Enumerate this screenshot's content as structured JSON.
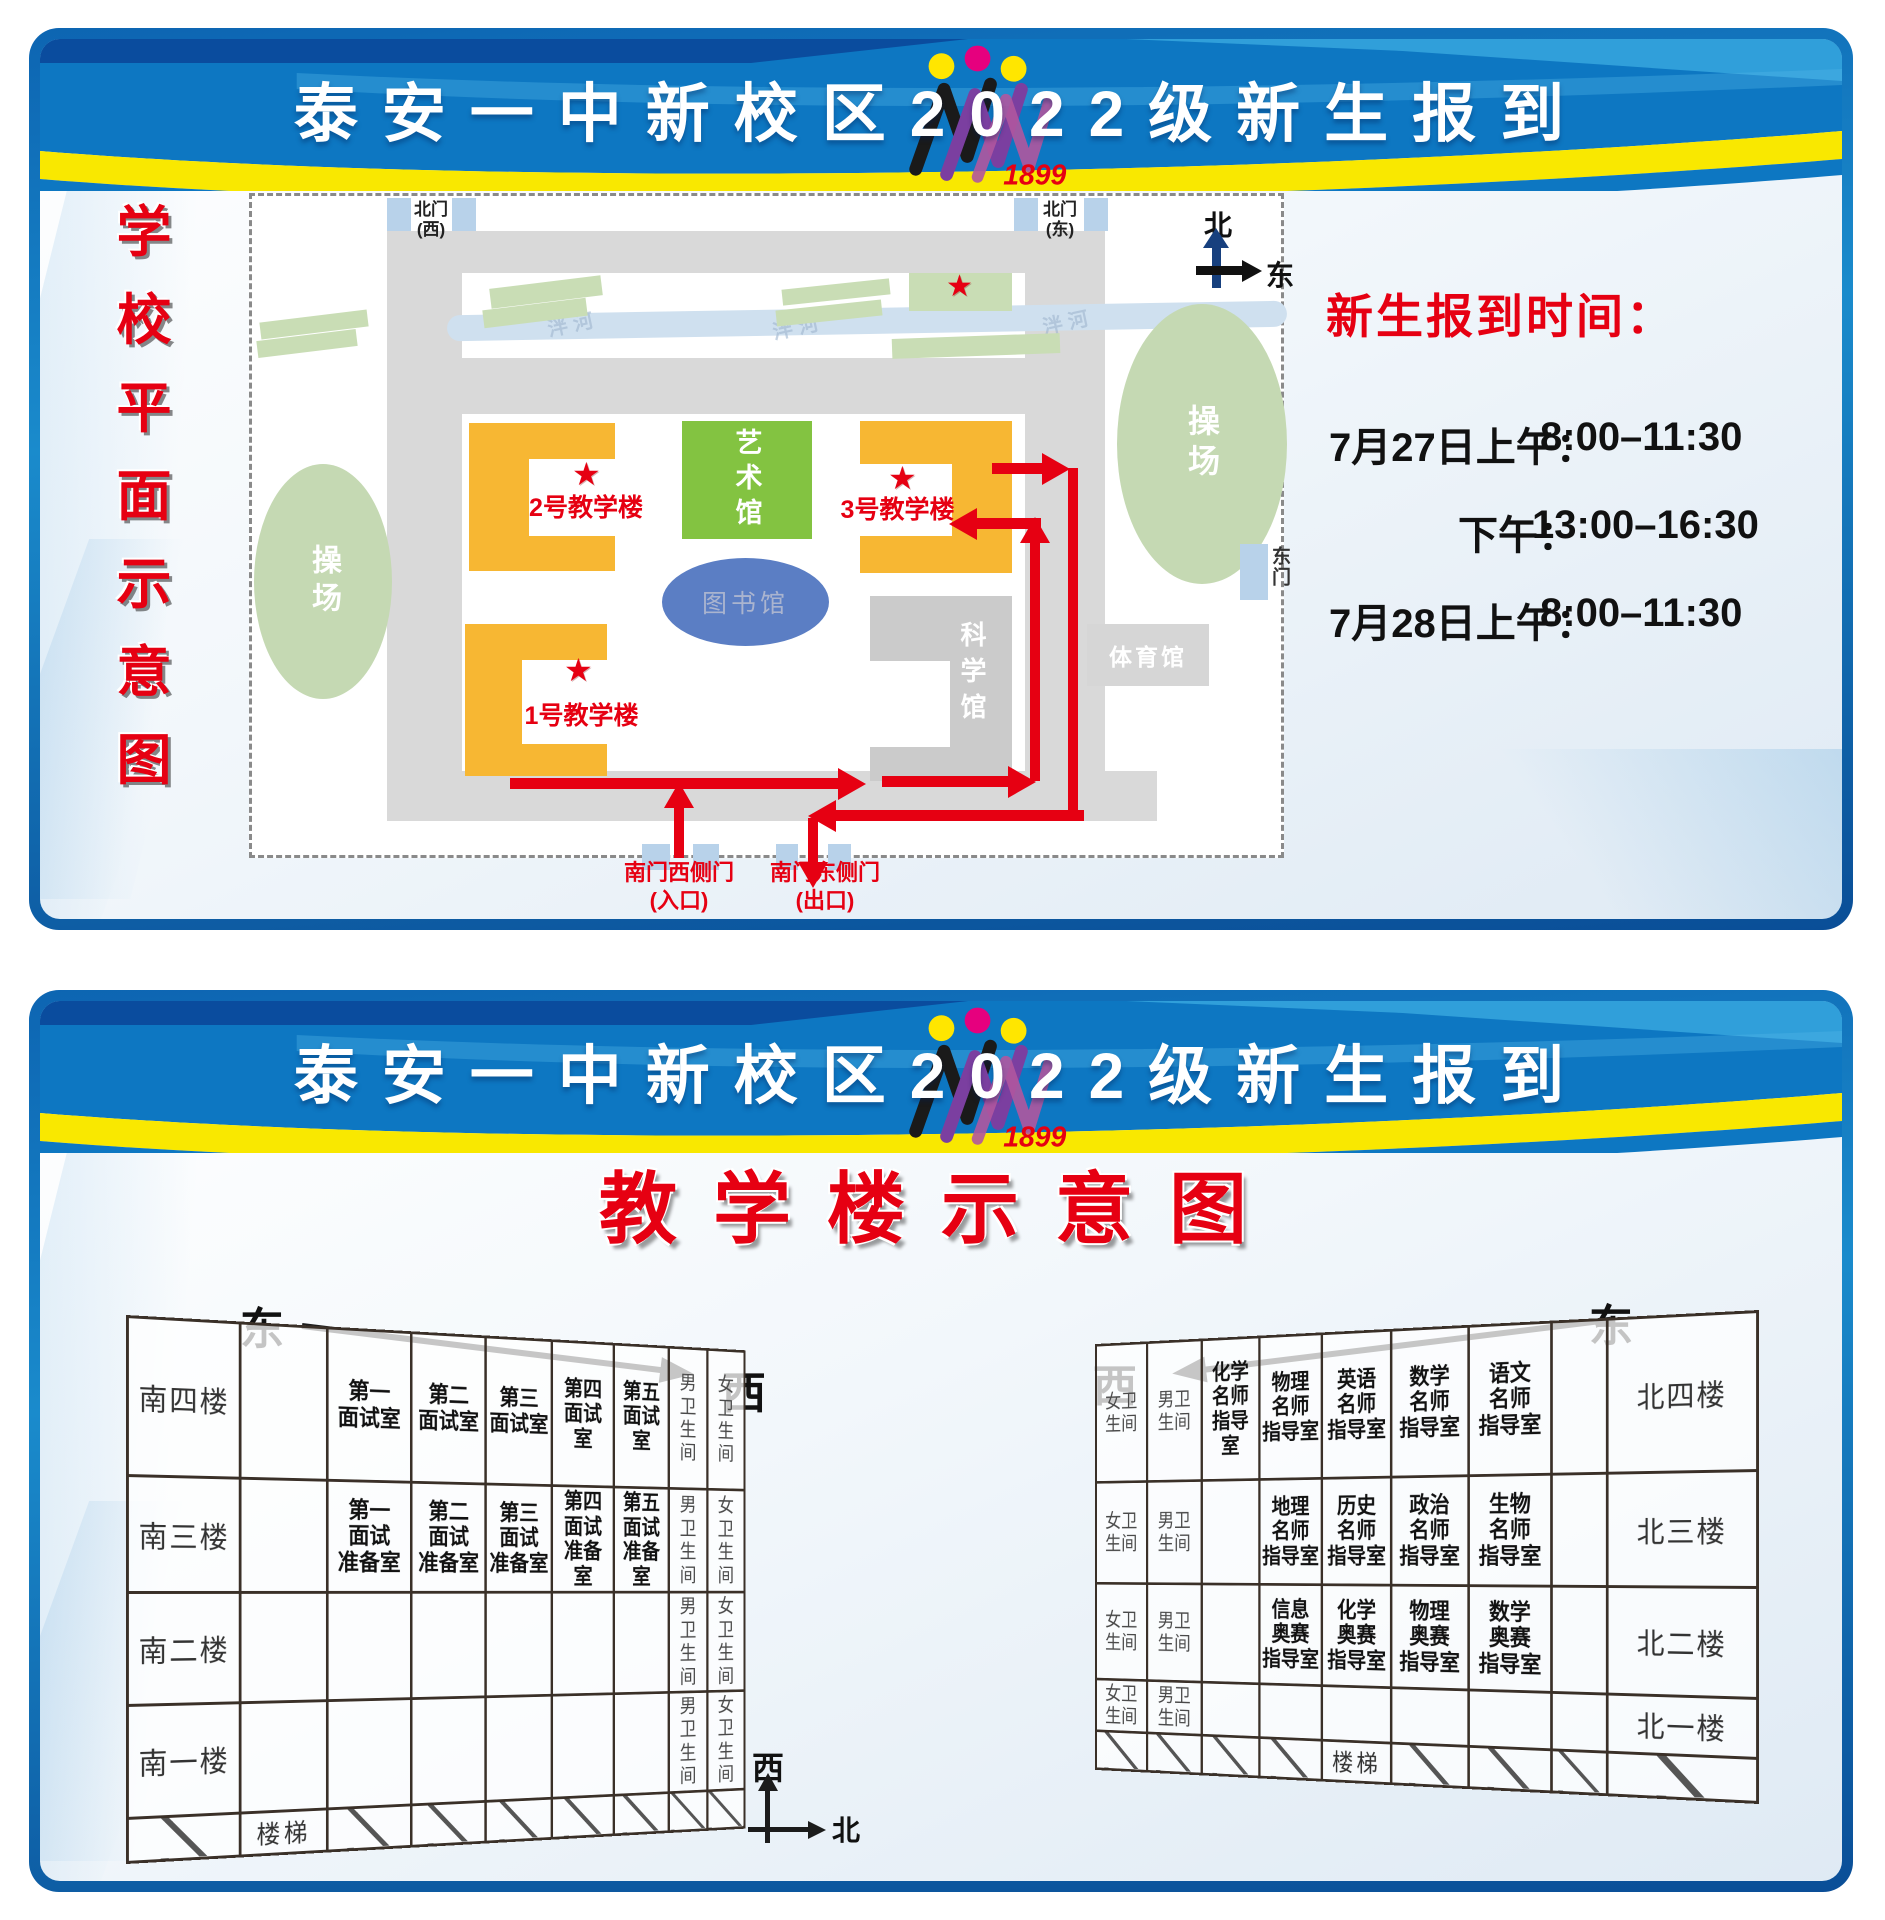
{
  "header": {
    "title": "泰安一中新校区2022级新生报到",
    "logo_year": "1899"
  },
  "panel1": {
    "side_title_chars": [
      "学",
      "校",
      "平",
      "面",
      "示",
      "意",
      "图"
    ],
    "map": {
      "north_gate_west": "北门\n(西)",
      "north_gate_east": "北门\n(东)",
      "east_gate": "东门",
      "south_gate_west": "南门西侧门",
      "south_gate_west_sub": "(入口)",
      "south_gate_east": "南门东侧门",
      "south_gate_east_sub": "(出口)",
      "compass_north": "北",
      "compass_east": "东",
      "building1": "1号教学楼",
      "building2": "2号教学楼",
      "building3": "3号教学楼",
      "art_hall": "艺术馆",
      "library": "图书馆",
      "science_hall": "科学馆",
      "gym": "体育馆",
      "playground_left": "操场",
      "playground_right": "操场",
      "river_label": "泮河",
      "star": "★"
    },
    "info": {
      "heading": "新生报到时间：",
      "lines": [
        {
          "label": "7月27日上午：",
          "time": "8:00–11:30"
        },
        {
          "label": "下午：",
          "time": "13:00–16:30"
        },
        {
          "label": "7月28日上午：",
          "time": "8:00–11:30"
        }
      ]
    }
  },
  "panel2": {
    "title": "教学楼示意图",
    "dir_east_left": "东",
    "dir_west_left": "西",
    "dir_west_right": "西",
    "dir_east_right": "东",
    "compass_west": "西",
    "compass_north": "北",
    "left_table": {
      "rows": [
        {
          "floor": "南四楼",
          "cells": [
            "",
            "第一\n面试室",
            "第二\n面试室",
            "第三\n面试室",
            "第四\n面试室",
            "第五\n面试室",
            "男卫\n生间",
            "女卫\n生间"
          ]
        },
        {
          "floor": "南三楼",
          "cells": [
            "",
            "第一\n面试\n准备室",
            "第二\n面试\n准备室",
            "第三\n面试\n准备室",
            "第四\n面试\n准备室",
            "第五\n面试\n准备室",
            "男卫\n生间",
            "女卫\n生间"
          ]
        },
        {
          "floor": "南二楼",
          "cells": [
            "",
            "",
            "",
            "",
            "",
            "",
            "男卫\n生间",
            "女卫\n生间"
          ]
        },
        {
          "floor": "南一楼",
          "cells": [
            "",
            "",
            "",
            "",
            "",
            "",
            "男卫\n生间",
            "女卫\n生间"
          ]
        }
      ],
      "stairs_label": "楼梯"
    },
    "right_table": {
      "rows": [
        {
          "floor": "北四楼",
          "cells": [
            "女卫\n生间",
            "男卫\n生间",
            "化学\n名师\n指导室",
            "物理\n名师\n指导室",
            "英语\n名师\n指导室",
            "数学\n名师\n指导室",
            "语文\n名师\n指导室",
            ""
          ]
        },
        {
          "floor": "北三楼",
          "cells": [
            "女卫\n生间",
            "男卫\n生间",
            "",
            "地理\n名师\n指导室",
            "历史\n名师\n指导室",
            "政治\n名师\n指导室",
            "生物\n名师\n指导室",
            ""
          ]
        },
        {
          "floor": "北二楼",
          "cells": [
            "女卫\n生间",
            "男卫\n生间",
            "",
            "信息\n奥赛\n指导室",
            "化学\n奥赛\n指导室",
            "物理\n奥赛\n指导室",
            "数学\n奥赛\n指导室",
            ""
          ]
        },
        {
          "floor": "北一楼",
          "cells": [
            "女卫\n生间",
            "男卫\n生间",
            "",
            "",
            "",
            "",
            "",
            ""
          ]
        }
      ],
      "stairs_label": "楼梯"
    }
  }
}
